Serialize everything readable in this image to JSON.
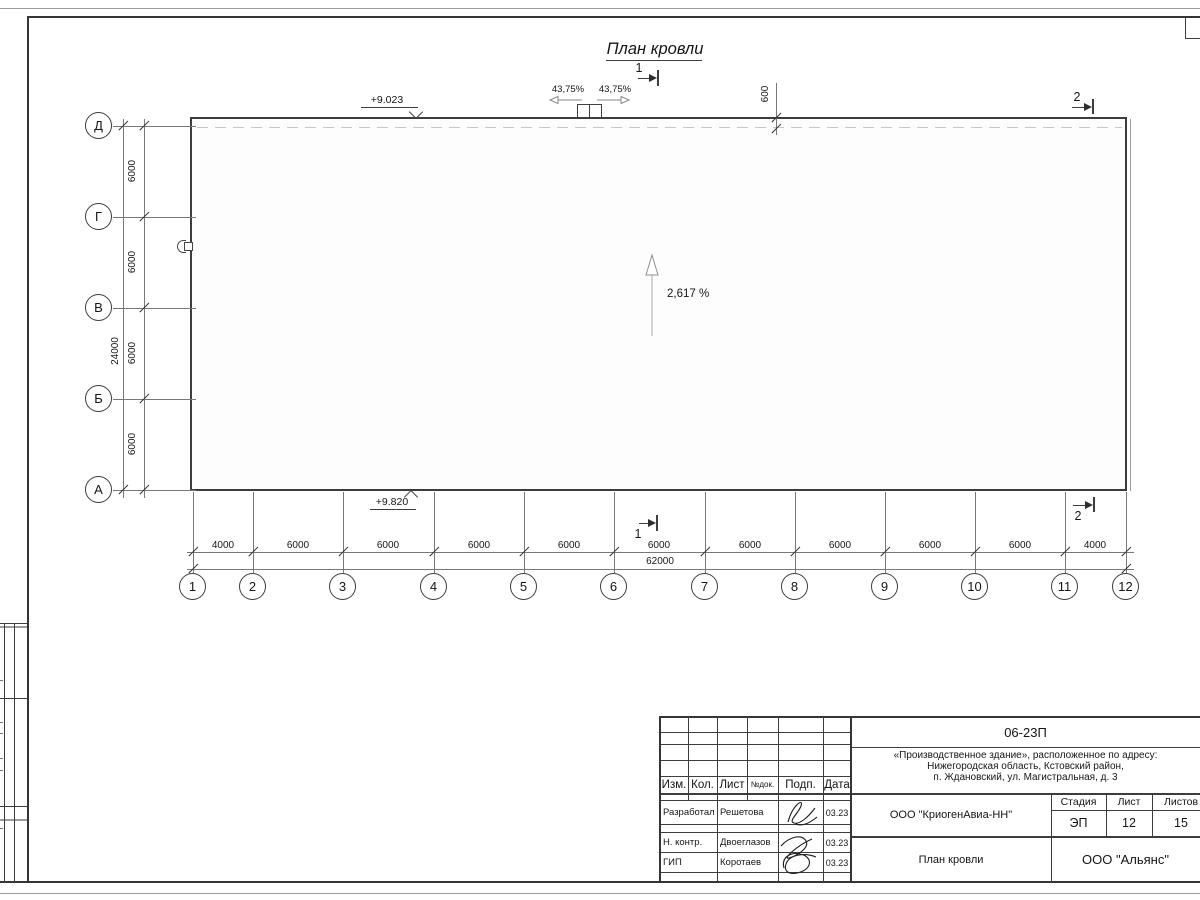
{
  "sheet": {
    "title": "План кровли",
    "slope": "2,617 %",
    "elevation_top": "+9.023",
    "elevation_bottom": "+9.820",
    "parapet_width": "600",
    "hatch_slope_left": "43,75%",
    "hatch_slope_right": "43,75%",
    "section1": "1",
    "section2": "2"
  },
  "axes": {
    "letters": [
      "Д",
      "Г",
      "В",
      "Б",
      "А"
    ],
    "letter_dims": [
      "6000",
      "6000",
      "6000",
      "6000"
    ],
    "letter_total": "24000",
    "numbers": [
      "1",
      "2",
      "3",
      "4",
      "5",
      "6",
      "7",
      "8",
      "9",
      "10",
      "11",
      "12"
    ],
    "number_dims": [
      "4000",
      "6000",
      "6000",
      "6000",
      "6000",
      "6000",
      "6000",
      "6000",
      "6000",
      "6000",
      "4000"
    ],
    "number_total": "62000"
  },
  "title_block": {
    "doc_number": "06-23П",
    "project_address_line1": "«Производственное здание», расположенное по адресу:",
    "project_address_line2": "Нижегородская область, Кстовский район,",
    "project_address_line3": "п. Ждановский, ул. Магистральная, д. 3",
    "columns": {
      "izm": "Изм.",
      "kol": "Кол.",
      "list": "Лист",
      "ndok": "№док.",
      "podp": "Подп.",
      "data": "Дата"
    },
    "rows": [
      {
        "role": "Разработал",
        "name": "Решетова",
        "date": "03.23"
      },
      {
        "role": "Н. контр.",
        "name": "Двоеглазов",
        "date": "03.23"
      },
      {
        "role": "ГИП",
        "name": "Коротаев",
        "date": "03.23"
      }
    ],
    "company": "ООО \"КриогенАвиа-НН\"",
    "stage_label": "Стадия",
    "stage_value": "ЭП",
    "sheet_label": "Лист",
    "sheet_value": "12",
    "sheets_label": "Листов",
    "sheets_value": "15",
    "drawing_name": "План кровли",
    "org_name": "ООО \"Альянс\""
  }
}
